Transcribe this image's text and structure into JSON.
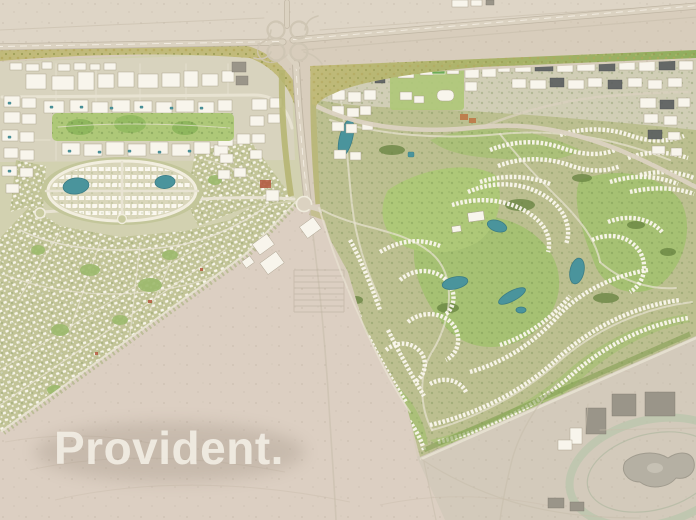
{
  "watermark": {
    "text": "Provident."
  },
  "map": {
    "type": "aerial-masterplan-render",
    "setting": "Desert master-planned community: apartment districts and an oval lagoon quarter on the left, a golf-course villa community on the right, a highway with cloverleaf interchange along the top, open desert with a racetrack at the bottom right",
    "features": [
      "desert-terrain",
      "highway",
      "cloverleaf-interchange",
      "landscaped-green-buffer",
      "apartment-district",
      "linear-central-park",
      "oval-lagoon-district",
      "twin-lagoon-lakes",
      "townhouse-rows",
      "villa-grid-district",
      "town-center-blocks",
      "boulevard",
      "golf-course-community",
      "golf-fairways",
      "golf-community-lakes",
      "villa-crescent-clusters",
      "school-campus-with-sports-field",
      "racetrack-oval",
      "stables-compound",
      "desert-roads",
      "watermark-logo"
    ],
    "palette": {
      "desert": "#d8cdbc",
      "desertLight": "#ded5c6",
      "desertPink": "#dccfc2",
      "desertGray": "#d3cabb",
      "roadFill": "#dbd2c1",
      "roadCase": "#c0b6a4",
      "roadLight": "#e8e3d2",
      "white": "#f8f5ec",
      "olive": "#c6c79c",
      "villaBg": "#c2c497",
      "villaRoof": "#f9f6ec",
      "green": "#9cba6c",
      "fairway": "#a6c173",
      "lawn": "#aec878",
      "darkTree": "#66823f",
      "beltYellow": "#c1ba7a",
      "lake": "#4a949c",
      "lakeDark": "#3b7c85",
      "urbanDark": "#5c6061",
      "accentRed": "#b2563c",
      "trackRing": "#bcc6ae",
      "grayBld": "#9a9589",
      "watermark": "#f4f0e7"
    }
  }
}
